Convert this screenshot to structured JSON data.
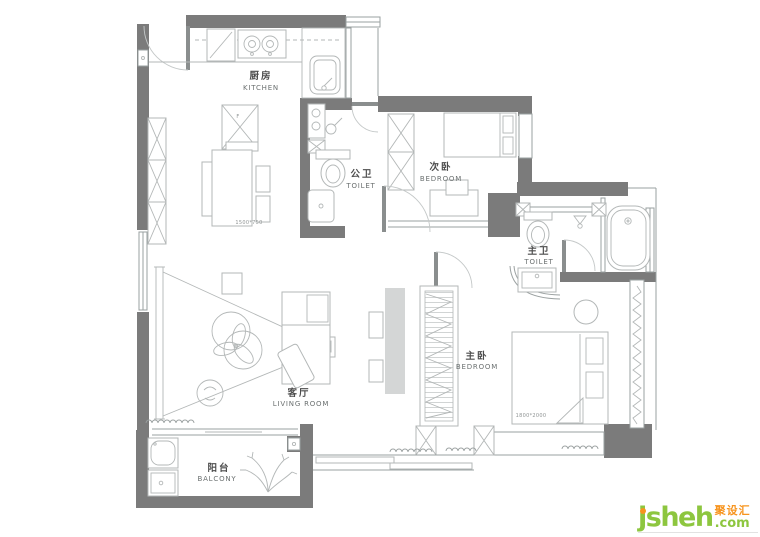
{
  "plan": {
    "rooms": {
      "kitchen": {
        "zh": "厨房",
        "en": "KITCHEN"
      },
      "guest_toilet": {
        "zh": "公卫",
        "en": "TOILET"
      },
      "second_bedroom": {
        "zh": "次卧",
        "en": "BEDROOM"
      },
      "master_toilet": {
        "zh": "主卫",
        "en": "TOILET"
      },
      "master_bedroom": {
        "zh": "主卧",
        "en": "BEDROOM"
      },
      "living_room": {
        "zh": "客厅",
        "en": "LIVING ROOM"
      },
      "balcony": {
        "zh": "阳台",
        "en": "BALCONY"
      }
    },
    "dimensions": {
      "dining_table": "1500*750",
      "master_bed": "1800*2000"
    },
    "annotations": {
      "island_mark": "F"
    },
    "colors": {
      "wall": "#7b7b7b",
      "line": "#9aa0a0",
      "furniture": "#b3b7b7",
      "label_zh": "#4c4c4c",
      "label_en": "#6b7070",
      "dim_text": "#8f9494"
    }
  },
  "watermark": {
    "brand": "jsheh",
    "tld": ".com",
    "cn": "聚设汇",
    "green": "#8dc63f",
    "orange": "#f7941e"
  }
}
